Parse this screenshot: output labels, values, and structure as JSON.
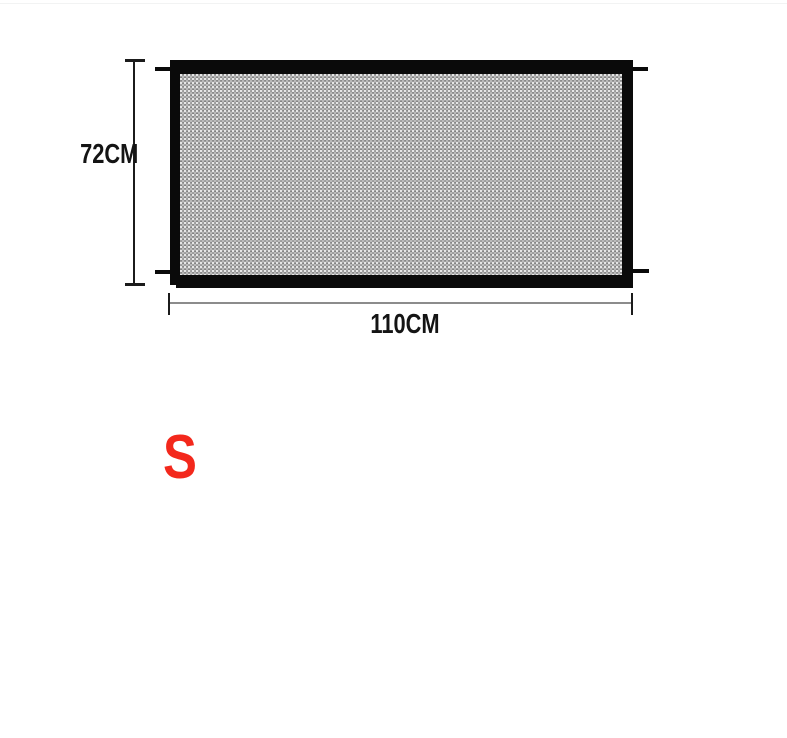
{
  "diagram": {
    "height_label": "72CM",
    "width_label": "110CM",
    "size_label": "S",
    "colors": {
      "background": "#ffffff",
      "frame_black": "#0a0a0a",
      "mesh_gray": "#9b9b9b",
      "dimension_dark": "#1b1b1b",
      "dimension_light": "#8c8c8c",
      "size_red": "#f3281c",
      "text": "#141414"
    }
  }
}
